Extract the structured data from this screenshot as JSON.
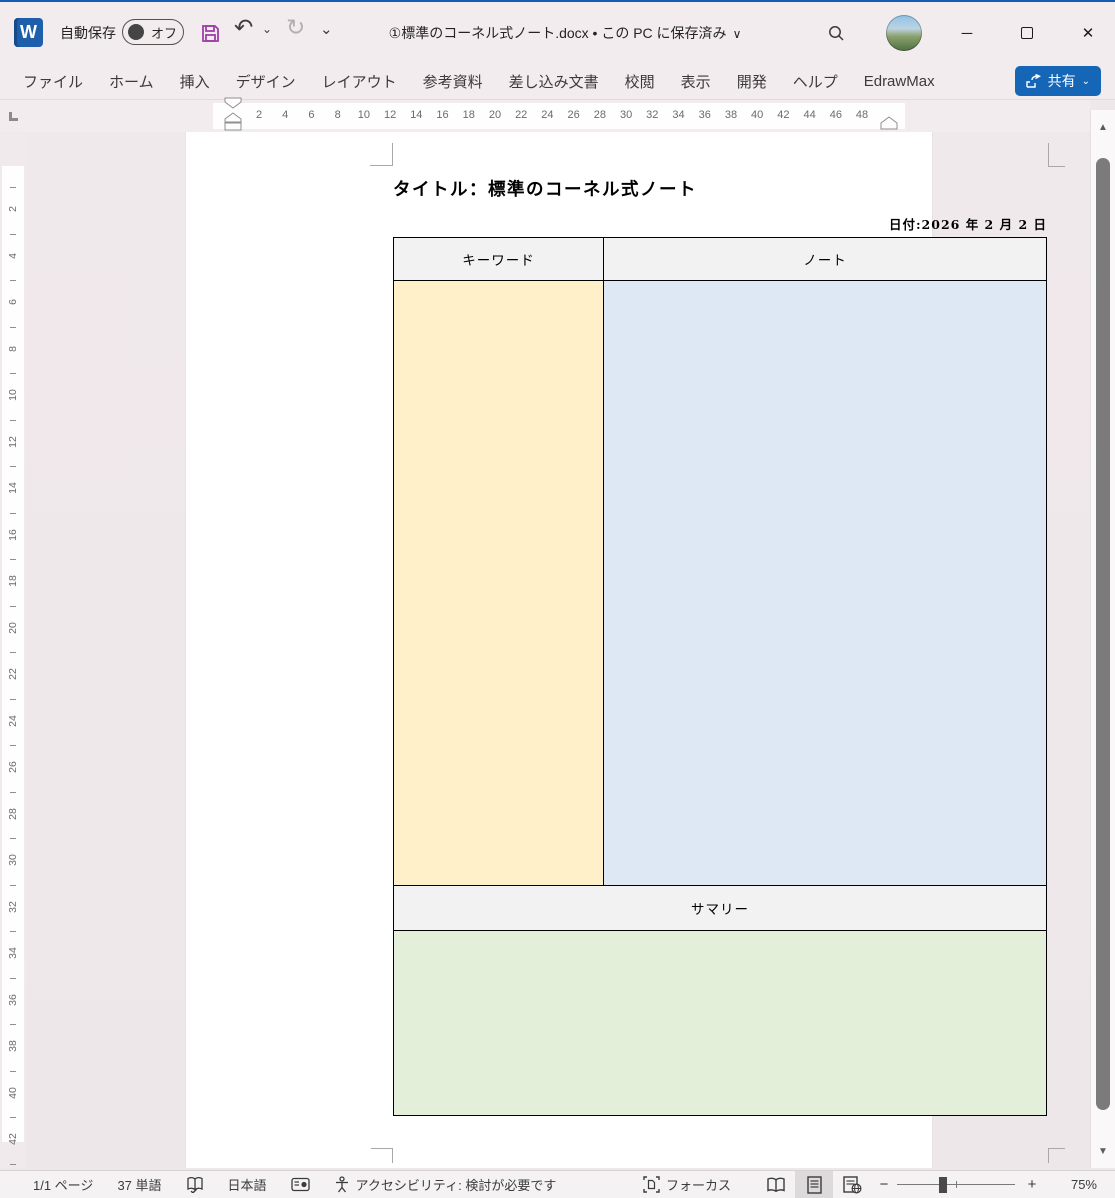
{
  "titlebar": {
    "autosave_label": "自動保存",
    "autosave_state": "オフ",
    "doc_title": "①標準のコーネル式ノート.docx • この PC に保存済み"
  },
  "icons": {
    "undo": "↶",
    "redo": "↻",
    "chevron_down": "⌄",
    "title_chevron": "∨",
    "word_logo_letter": "W",
    "minimize": "─",
    "close": "✕",
    "scroll_up": "▲",
    "scroll_down": "▼"
  },
  "ribbon": {
    "tabs": [
      {
        "label": "ファイル"
      },
      {
        "label": "ホーム"
      },
      {
        "label": "挿入"
      },
      {
        "label": "デザイン"
      },
      {
        "label": "レイアウト"
      },
      {
        "label": "参考資料"
      },
      {
        "label": "差し込み文書"
      },
      {
        "label": "校閲"
      },
      {
        "label": "表示"
      },
      {
        "label": "開発"
      },
      {
        "label": "ヘルプ"
      },
      {
        "label": "EdrawMax"
      }
    ],
    "share_label": "共有"
  },
  "ruler": {
    "h_numbers": [
      2,
      4,
      6,
      8,
      10,
      12,
      14,
      16,
      18,
      20,
      22,
      24,
      26,
      28,
      30,
      32,
      34,
      36,
      38,
      40,
      42,
      44,
      46,
      48
    ],
    "v_numbers": [
      2,
      4,
      6,
      8,
      10,
      12,
      14,
      16,
      18,
      20,
      22,
      24,
      26,
      28,
      30,
      32,
      34,
      36,
      38,
      40,
      42
    ]
  },
  "page": {
    "title": "タイトル：標準のコーネル式ノート",
    "date": "日付:2026 年 2 月 2 日",
    "table": {
      "keyword_header": "キーワード",
      "note_header": "ノート",
      "summary_header": "サマリー",
      "colors": {
        "header_bg": "#F2F2F2",
        "keyword_bg": "#FFF0CA",
        "note_bg": "#DEE8F4",
        "summary_bg": "#E3EFD9"
      }
    }
  },
  "statusbar": {
    "page_count": "1/1 ページ",
    "word_count": "37 単語",
    "language": "日本語",
    "accessibility": "アクセシビリティ: 検討が必要です",
    "focus_label": "フォーカス",
    "zoom_minus": "−",
    "zoom_plus": "+",
    "zoom_level": "75%"
  },
  "colors": {
    "accent_blue": "#1566b7",
    "save_purple": "#a03fa8",
    "top_accent": "#155bb0"
  }
}
